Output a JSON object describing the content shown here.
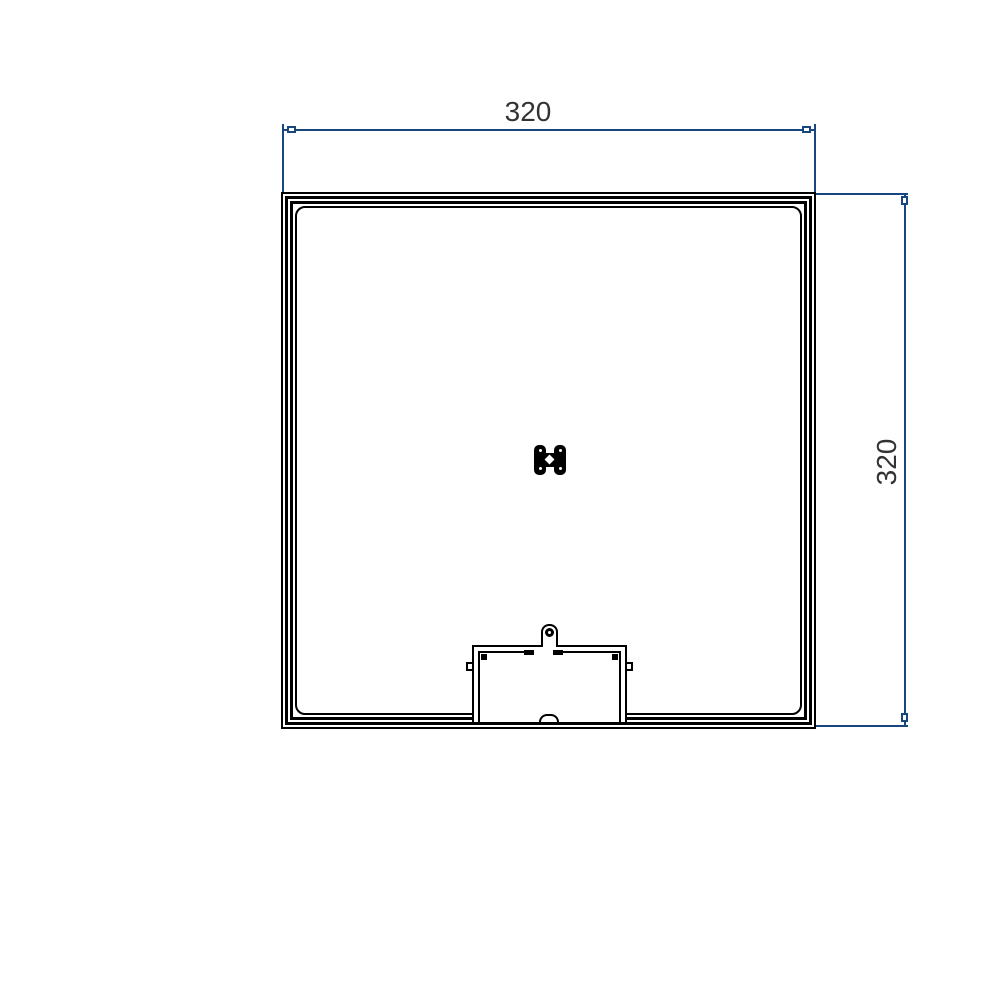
{
  "drawing": {
    "dimensions": {
      "horizontal": {
        "label": "320"
      },
      "vertical": {
        "label": "320"
      }
    },
    "colors": {
      "dimension_line": "#17477e",
      "drawing_line": "#000000",
      "dimension_text": "#333333",
      "background": "#ffffff"
    },
    "symbols": {
      "center_handle": "lid-handle-icon",
      "hinge_tab": "hinge-tab-icon"
    }
  }
}
